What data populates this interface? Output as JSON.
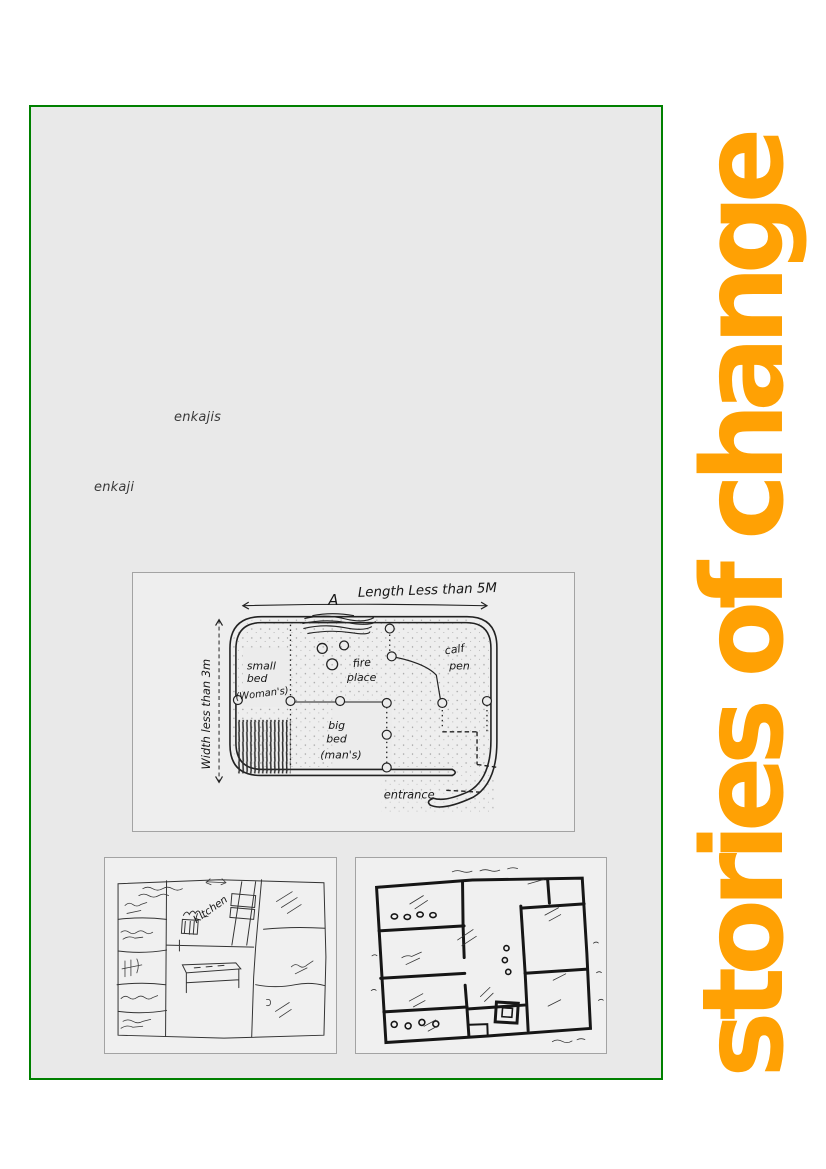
{
  "banner": {
    "text": "stories of change",
    "color": "#FFA104"
  },
  "panel": {
    "background": "#e9e9e9",
    "border_color": "#008000"
  },
  "body_words": {
    "enkajis": "enkajis",
    "enkaji": "enkaji"
  },
  "ink_color": "#1f1f1f",
  "main_figure": {
    "description": "hand-drawn floor plan of a traditional enkaji house",
    "labels": {
      "marker_a": "A",
      "length": "Length Less than 5M",
      "width": "Width less than 3m",
      "small_bed_l1": "small",
      "small_bed_l2": "bed",
      "small_bed_l3": "(Woman's)",
      "fire_l1": "fire",
      "fire_l2": "place",
      "big_bed_l1": "big",
      "big_bed_l2": "bed",
      "big_bed_l3": "(man's)",
      "calf_l1": "calf",
      "calf_l2": "pen",
      "entrance": "entrance"
    }
  },
  "sketch_left": {
    "description": "hand-drawn pen floor plan of a modern house",
    "labels": {
      "kitchen": "Kitchen"
    }
  },
  "sketch_right": {
    "description": "hand-drawn marker floor plan of a modern house"
  }
}
